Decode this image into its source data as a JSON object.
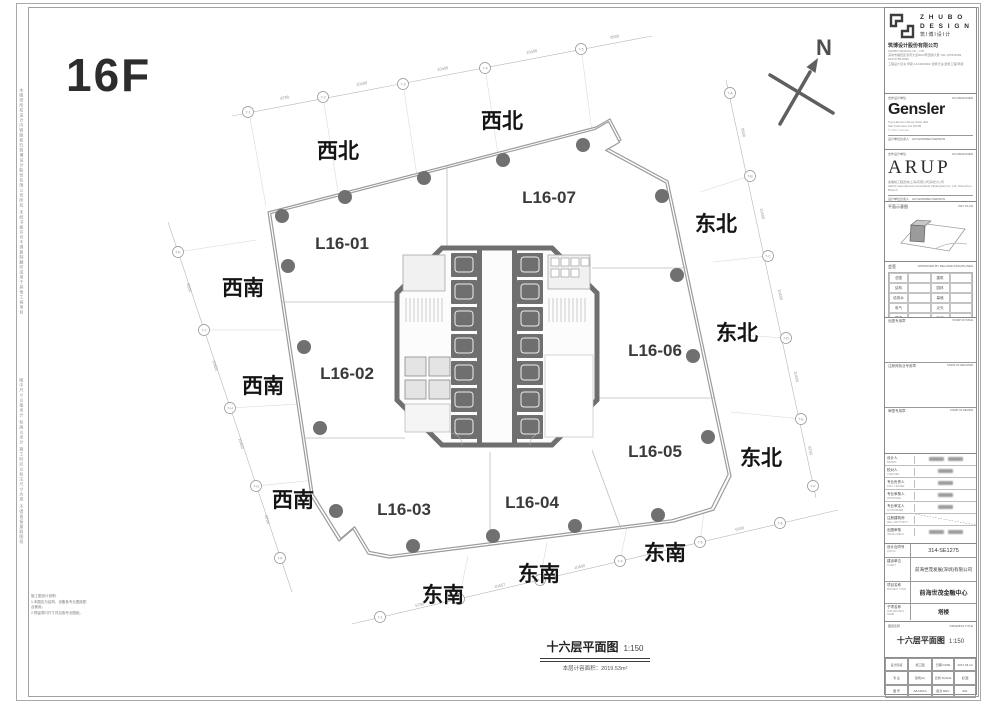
{
  "page": {
    "floor_label": "16F",
    "north_label": "N",
    "colors": {
      "wall": "#6f6f6f",
      "line": "#b0b0b0",
      "column": "#707070"
    }
  },
  "plan": {
    "units": [
      "L16-01",
      "L16-02",
      "L16-03",
      "L16-04",
      "L16-05",
      "L16-06",
      "L16-07"
    ],
    "directions": [
      "西北",
      "西北",
      "西南",
      "西南",
      "西南",
      "东南",
      "东南",
      "东南",
      "东北",
      "东北",
      "东北"
    ],
    "caption": {
      "title": "十六层平面图",
      "scale": "1:150",
      "area_label": "本层计容面积：",
      "area_value": "2019.53m²"
    },
    "grid": {
      "top": [
        "7-1",
        "7-2",
        "7-3",
        "7-4",
        "7-5"
      ],
      "right": [
        "7-A",
        "7-B",
        "7-C",
        "7-D",
        "7-E",
        "7-F"
      ],
      "bottom": [
        "7-1",
        "7-2",
        "7-3",
        "7-4",
        "7-5",
        "7-6"
      ],
      "left": [
        "7-K",
        "7-J",
        "7-H",
        "7-G",
        "7-F"
      ]
    },
    "dims": {
      "top": [
        "8700",
        "10400",
        "10400",
        "10400",
        "8500"
      ],
      "right": [
        "8500",
        "10400",
        "10400",
        "10400",
        "8700"
      ],
      "bottom": [
        "6700",
        "10457",
        "10400",
        "8400",
        "6500"
      ],
      "left": [
        "8500",
        "10400",
        "10400",
        "8700"
      ]
    }
  },
  "margins": {
    "left_note_top": "本图纸所有设计内容版权归筑博设计股份有限公司所有 未经书面许可不得复制翻印或用于其他工程项目",
    "left_note_bottom": "图中尺寸以毫米计 标高以米计 施工时应以标注尺寸为准 不得直接量取图纸",
    "corner_note_title": "施工图设计说明:",
    "corner_note_1": "1.本图应与结构、设备各专业图纸配合使用。",
    "corner_note_2": "2.预留洞口尺寸详见各专业图纸。"
  },
  "titleblock": {
    "zhubo": {
      "brand_line1": "Z H U B O",
      "brand_line2": "D E S I G N",
      "brand_cn": "筑I博I设I计",
      "company": "筑博设计股份有限公司",
      "company_en": "ZHUBO DESIGN CO., LTD.",
      "addr": "深圳市福田区滨河大道9023号国通大厦 TEL:0755-8299 FAX:0755-8299",
      "cert": "工程设计证书 甲级 A144003962 建筑行业(建筑工程)甲级"
    },
    "gensler": {
      "header": "合作设计单位",
      "header_en": "CO-DESIGNER",
      "logo": "Gensler",
      "addr1": "Two Harrison Street Suite 400",
      "addr2": "San Francisco CA 94105",
      "addr3": "Telephone 415.433.3700",
      "copyright": "© 2017 Gensler",
      "resp_label": "设计单位负责人",
      "resp_en": "AUTHORIZED PERSON"
    },
    "arup": {
      "header": "合作设计单位",
      "header_en": "CO-DESIGNER",
      "logo": "ARUP",
      "addr1": "奥雅纳工程咨询(上海)有限公司深圳分公司",
      "addr2": "ARUP International Consultants (Shanghai) Co. Ltd. Shenzhen Branch",
      "resp_label": "设计单位负责人",
      "resp_en": "AUTHORIZED PERSON"
    },
    "keyplan": {
      "label": "平面示意图",
      "label_en": "KEY PLAN"
    },
    "signoff": {
      "header": "会签",
      "header_en": "APPROVED BY RELATED DISCIPLINES",
      "cells": [
        "总图",
        "建筑",
        "结构",
        "园林",
        "给排水",
        "幕墙",
        "电气",
        "泛光",
        "暖通",
        "标识"
      ]
    },
    "stamps": [
      {
        "label": "出图专用章",
        "en": "STAMP OF ISSUE"
      },
      {
        "label": "注册师执业专用章",
        "en": "STAMP OF REGISTER"
      },
      {
        "label": "审图专用章",
        "en": "STAMP OF REVIEW"
      }
    ],
    "signatures": {
      "rows": [
        {
          "label": "设计人",
          "en": "DRAWN"
        },
        {
          "label": "校对人",
          "en": "CHECKED"
        },
        {
          "label": "专业负责人",
          "en": "DISC. LEADER"
        },
        {
          "label": "专业审核人",
          "en": "APPROVER"
        },
        {
          "label": "专业审定人",
          "en": "AUTHORIZER"
        },
        {
          "label": "注册建筑师",
          "en": "REG. ARCHITECT"
        },
        {
          "label": "出图审核",
          "en": "ISSUE CHECK"
        }
      ]
    },
    "info": {
      "job_label": "设计合同号",
      "job_en": "JOB No.",
      "job_value": "314-SE1275",
      "client_label": "建设单位",
      "client_en": "CLIENT",
      "client_value": "前海世茂发展(深圳)有限公司",
      "project_label": "项目名称",
      "project_en": "PROJECT TITLE",
      "project_value": "前海世茂金融中心",
      "sub_label": "子项名称",
      "sub_en": "SUB PROJECT NAME",
      "sub_value": "塔楼"
    },
    "drawing": {
      "header": "图纸名称",
      "header_en": "DRAWING TITLE",
      "title": "十六层平面图",
      "scale": "1:150"
    },
    "table": {
      "r1c1": "设计阶段",
      "r1c2": "施工图",
      "r1c3": "日期 DATE",
      "r1c4": "2017.04.14",
      "r2c1": "专 业",
      "r2c2": "建筑(A)",
      "r2c3": "比例 SCALE",
      "r2c4": "如 图",
      "r3c1": "图 号",
      "r3c2": "A8-1601A",
      "r3c3": "版次 REV.",
      "r3c4": "001"
    }
  }
}
